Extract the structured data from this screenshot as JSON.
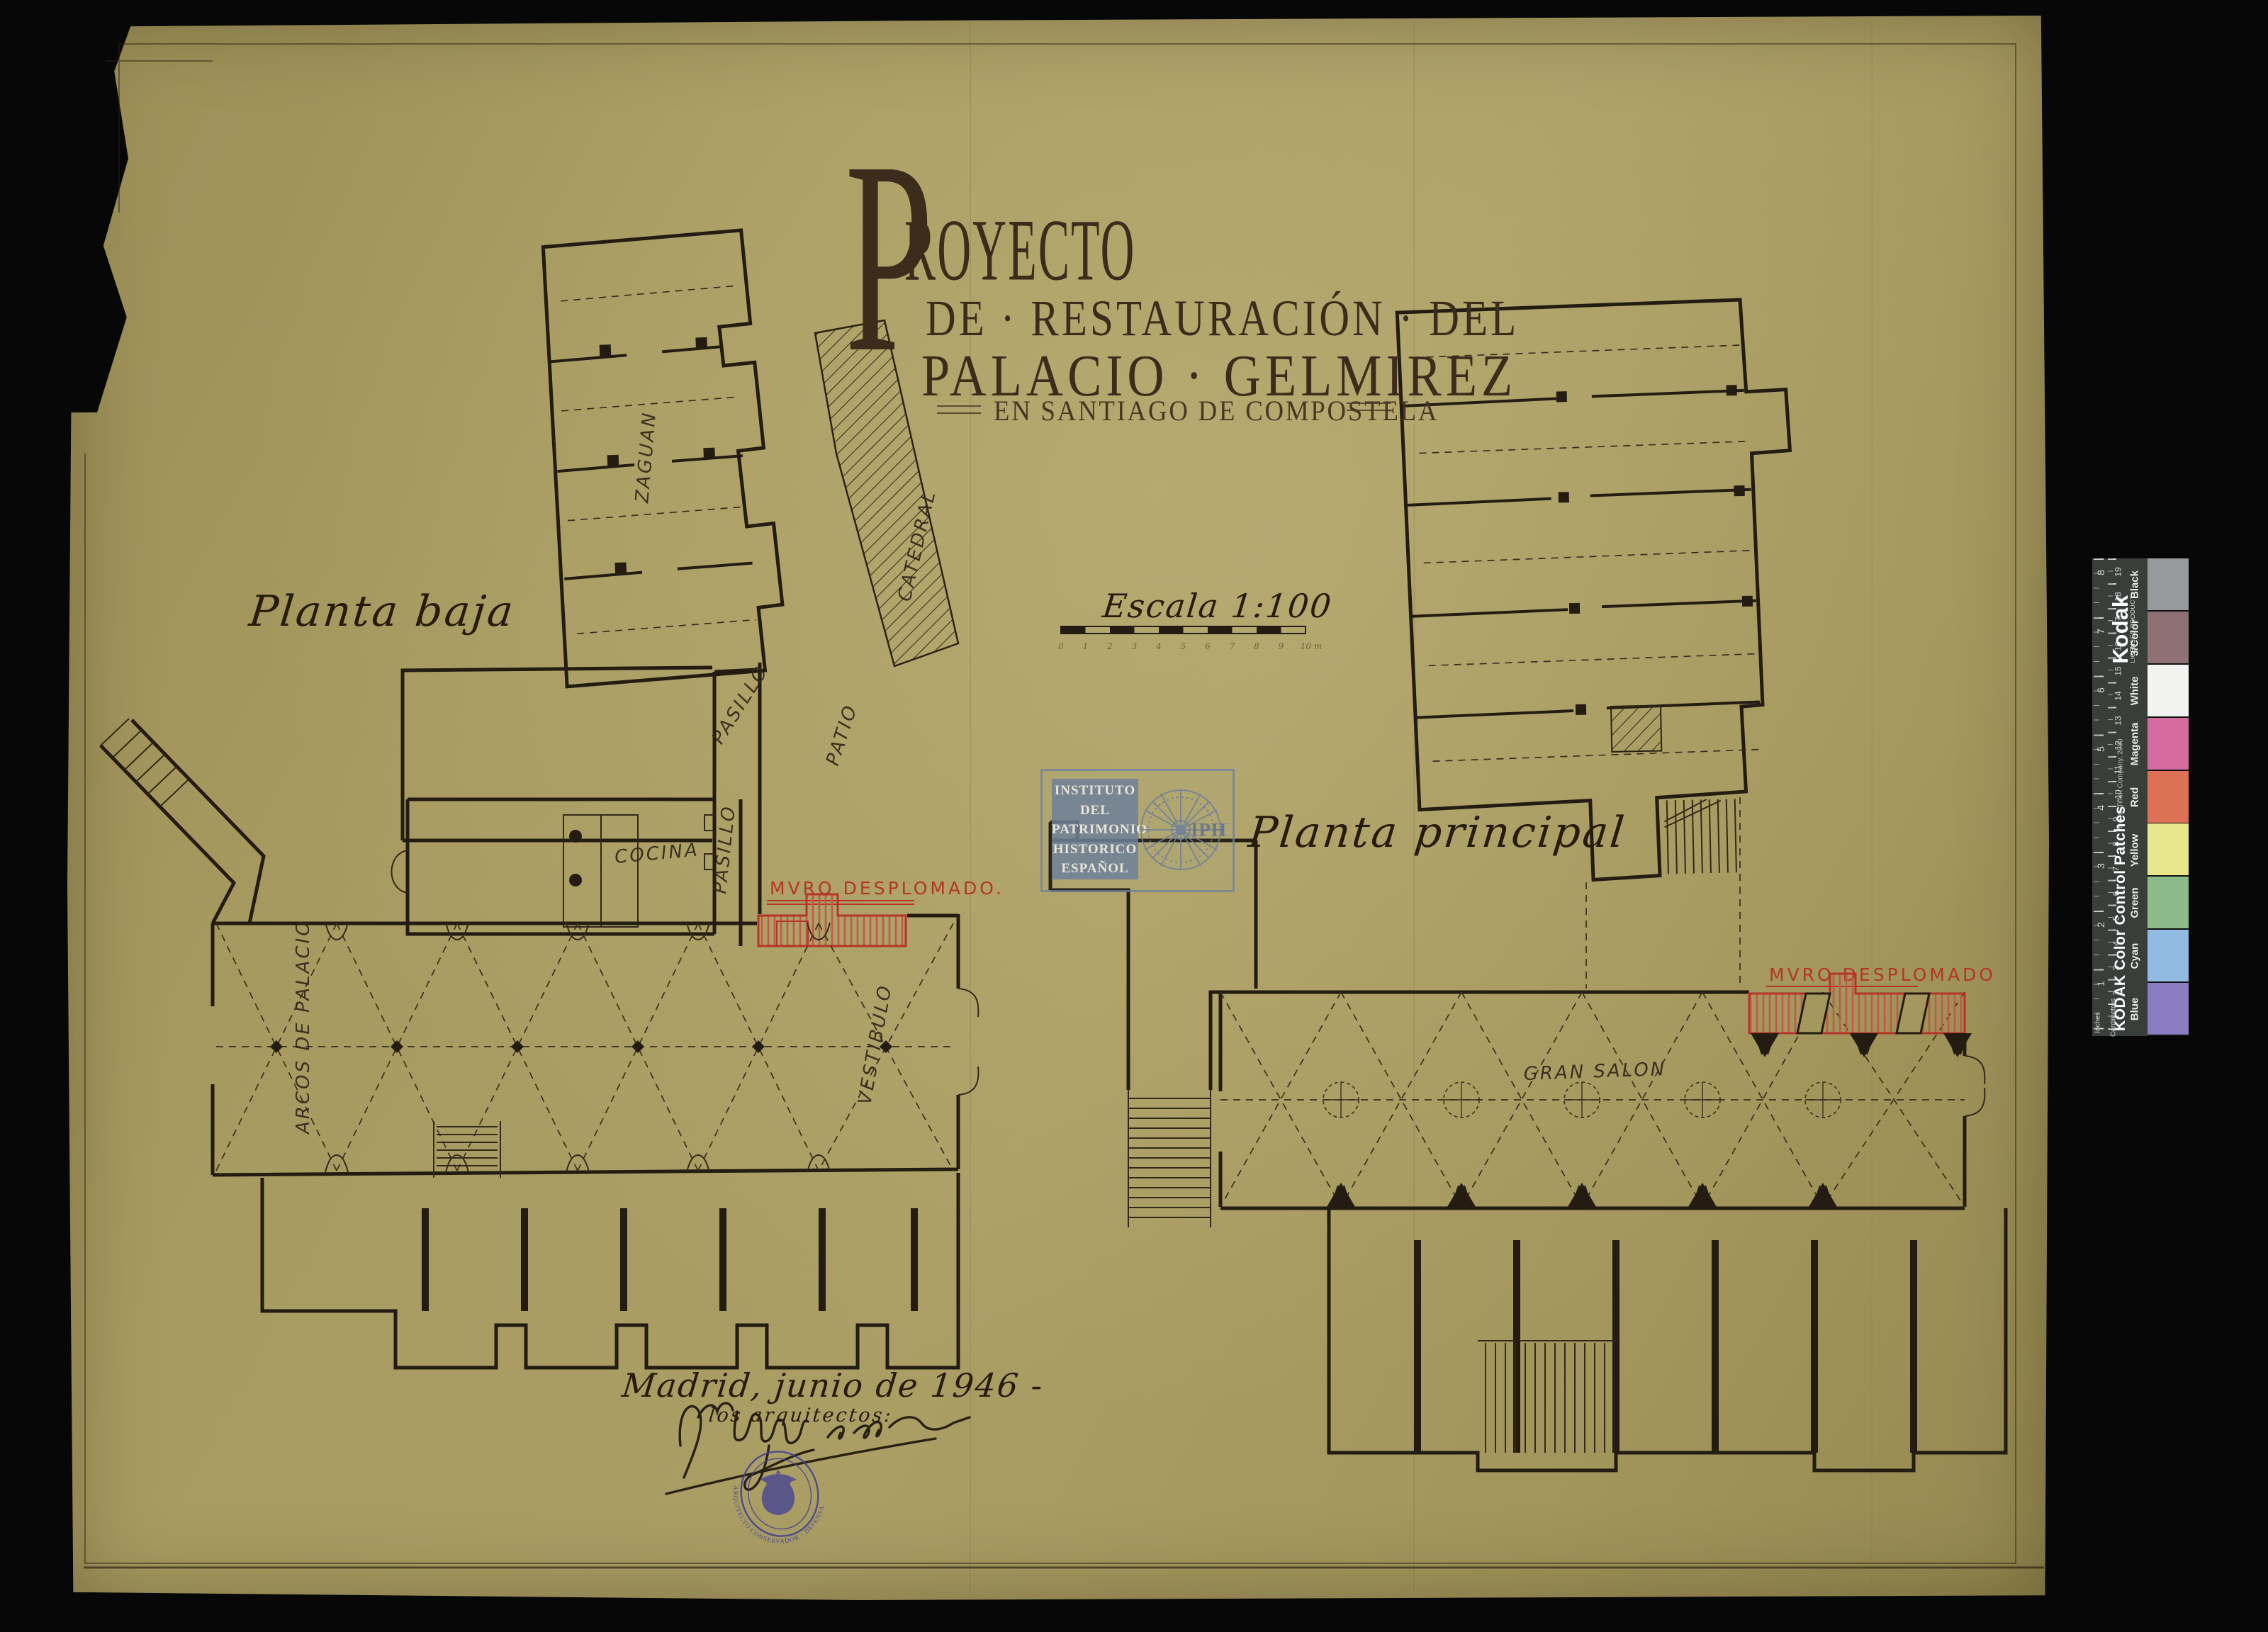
{
  "palette": {
    "background": "#070707",
    "paper": "#a89b61",
    "ink": "#241c12",
    "damage_red": "#b43527",
    "iphe_blue": "#6e809a",
    "seal_blue": "#3f3e97",
    "kodak_strip_bg": "#3a3e3b"
  },
  "title": {
    "initial": "P",
    "word_rest": "ROYECTO",
    "line2": "DE · RESTAURACIÓN · DEL",
    "line3": "PALACIO · GELMIREZ",
    "line4": "EN SANTIAGO DE COMPOSTELA"
  },
  "plans": {
    "left": {
      "caption": "Planta baja",
      "damage_label": "MVRO DESPLOMADO.",
      "rooms": {
        "zaguan": "ZAGUAN",
        "pasillo1": "PASILLO",
        "pasillo2": "PASILLO",
        "patio": "PATIO",
        "cocina": "COCINA",
        "vestibulo": "VESTIBULO",
        "arcos": "ARCOS DE PALACIO",
        "catedral": "CATEDRAL"
      }
    },
    "right": {
      "caption": "Planta principal",
      "damage_label": "MVRO DESPLOMADO",
      "rooms": {
        "gran_salon": "GRAN SALON"
      }
    }
  },
  "scale": {
    "label": "Escala 1:100",
    "ticks": [
      "0",
      "1",
      "2",
      "3",
      "4",
      "5",
      "6",
      "7",
      "8",
      "9"
    ],
    "end_label": "10 m"
  },
  "iphe_stamp": {
    "lines": [
      "INSTITUTO",
      "DEL",
      "PATRIMONIO",
      "HISTORICO",
      "ESPAÑOL"
    ],
    "acronym": "IPHE"
  },
  "signature_block": {
    "date_line": "Madrid, junio de 1946 -",
    "caption": "los arquitectos:"
  },
  "seal": {
    "text_top": "PRIMERA",
    "text_bottom": "ARQUITECTO CONSERVADOR · DEFENSA DEL PATRIMONIO ARTISTICO"
  },
  "kodak": {
    "brand": "Kodak",
    "licensed": "LICENSED PRODUCT",
    "title": "KODAK Color Control Patches",
    "copyright": "© The Tiffen Company, 2000",
    "cm_label": "Centimetres",
    "in_label": "Inches",
    "cm_numbers": [
      "1",
      "2",
      "3",
      "4",
      "5",
      "6",
      "7",
      "8",
      "9",
      "10",
      "11",
      "12",
      "13",
      "14",
      "15",
      "16",
      "17",
      "18",
      "19"
    ],
    "in_numbers": [
      "1",
      "2",
      "3",
      "4",
      "5",
      "6",
      "7",
      "8"
    ],
    "patches": [
      {
        "label": "Black",
        "color": "#97999c"
      },
      {
        "label": "3/Color",
        "color": "#8e7172"
      },
      {
        "label": "White",
        "color": "#f2f3f0"
      },
      {
        "label": "Magenta",
        "color": "#d56c9f"
      },
      {
        "label": "Red",
        "color": "#dc7156"
      },
      {
        "label": "Yellow",
        "color": "#e9e78c"
      },
      {
        "label": "Green",
        "color": "#8cba89"
      },
      {
        "label": "Cyan",
        "color": "#92bbe2"
      },
      {
        "label": "Blue",
        "color": "#8a7dc2"
      }
    ]
  }
}
